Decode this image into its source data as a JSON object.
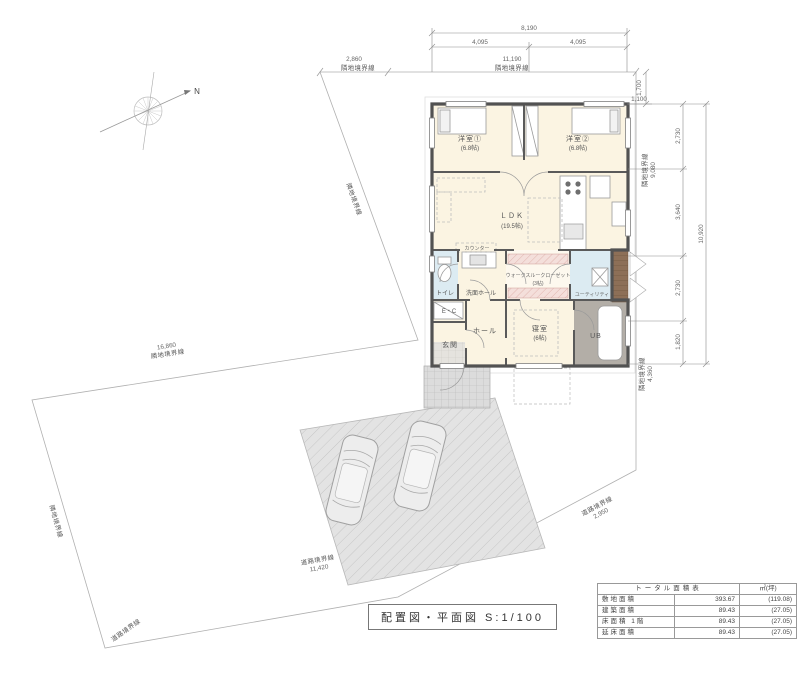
{
  "meta": {
    "drawing_title": "配置図・平面図 S:1/100"
  },
  "compass": {
    "north": "N"
  },
  "dims": {
    "top_total": "8,190",
    "top_half_left": "4,095",
    "top_half_right": "4,095",
    "offset_v": "1,700",
    "offset_h": "1,100",
    "right_seg_1": "2,730",
    "right_seg_2": "3,640",
    "right_seg_3": "2,730",
    "right_seg_4": "1,820",
    "right_total": "10,920"
  },
  "boundaries": {
    "top_left": {
      "dim": "2,860",
      "label": "隣地境界線"
    },
    "top": {
      "dim": "11,190",
      "label": "隣地境界線"
    },
    "left_upper": {
      "dim": "16,860",
      "label": "隣地境界線"
    },
    "left_diag": {
      "label": "隣地境界線"
    },
    "left_lower": {
      "label": "隣地境界線"
    },
    "right_upper": {
      "dim": "9,080",
      "label": "隣地境界線"
    },
    "right_lower": {
      "dim": "4,360",
      "label": "隣地境界線"
    },
    "road_bottom": {
      "dim": "11,420",
      "label": "道路境界線"
    },
    "road_bottom_left": {
      "label": "道路境界線"
    },
    "road_right": {
      "dim": "2,950",
      "label": "道路境界線"
    }
  },
  "rooms": {
    "yoshitsu1": {
      "name": "洋室①",
      "size": "(6.8帖)"
    },
    "yoshitsu2": {
      "name": "洋室②",
      "size": "(6.8帖)"
    },
    "ldk": {
      "name": "ＬＤＫ",
      "size": "(19.5帖)"
    },
    "counter": {
      "name": "カウンター"
    },
    "toilet": {
      "name": "トイレ"
    },
    "senmen": {
      "name": "洗面ホール"
    },
    "wtc": {
      "name": "ウォークスルークローゼット",
      "size": "(3帖)"
    },
    "utility": {
      "name": "ユーティリティ"
    },
    "ec": {
      "name": "E・C"
    },
    "genkan": {
      "name": "玄関"
    },
    "hall": {
      "name": "ホール"
    },
    "shinshitsu": {
      "name": "寝室",
      "size": "(6帖)"
    },
    "ub": {
      "name": "UB"
    }
  },
  "area_table": {
    "title": "トータル面積表",
    "unit_header": "㎡(坪)",
    "rows": [
      {
        "label": "敷地面積",
        "m2": "393.67",
        "tsubo": "(119.08)"
      },
      {
        "label": "建築面積",
        "m2": "89.43",
        "tsubo": "(27.05)"
      },
      {
        "label": "床面積 1階",
        "m2": "89.43",
        "tsubo": "(27.05)"
      },
      {
        "label": "延床面積",
        "m2": "89.43",
        "tsubo": "(27.05)"
      }
    ]
  },
  "colors": {
    "room_cream": "#fbf4e2",
    "room_blue": "#dcebf2",
    "closet_pink": "#f4dfdb",
    "ub_gray": "#b3aea7",
    "deck_brown": "#8d6f57",
    "wall": "#525252"
  }
}
